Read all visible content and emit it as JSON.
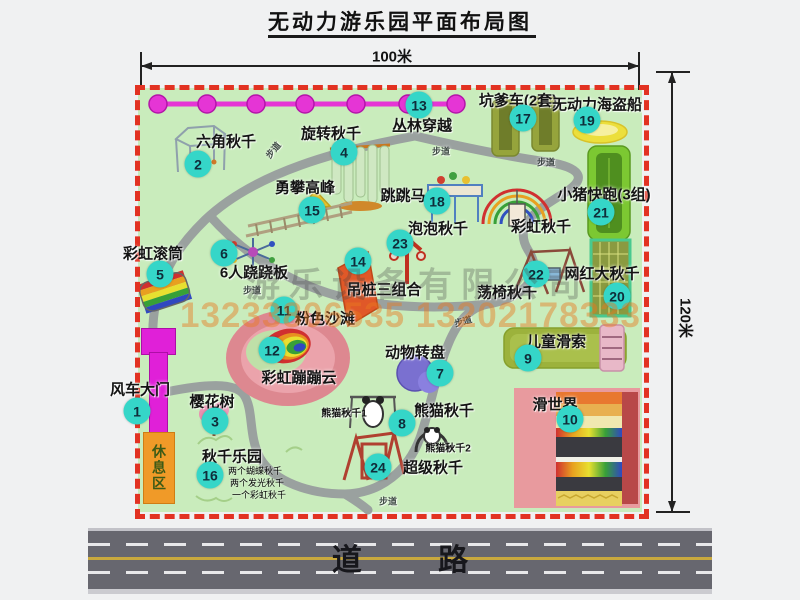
{
  "title": "无动力游乐园平面布局图",
  "dimensions": {
    "width_label": "100米",
    "height_label": "120米"
  },
  "road": {
    "label": "道 路"
  },
  "watermark": {
    "company": "游乐设备有限公司",
    "phone": "13233806535 13202178333"
  },
  "rest_area_label": "休息区",
  "walkway_label": "步道",
  "items": [
    {
      "num": "1",
      "label": "风车大门"
    },
    {
      "num": "2",
      "label": "六角秋千"
    },
    {
      "num": "3",
      "label": "樱花树"
    },
    {
      "num": "4",
      "label": "旋转秋千"
    },
    {
      "num": "5",
      "label": "彩虹滚筒"
    },
    {
      "num": "6",
      "label": "6人跷跷板"
    },
    {
      "num": "7",
      "label": "动物转盘"
    },
    {
      "num": "8",
      "label": "熊猫秋千"
    },
    {
      "num": "9",
      "label": "儿童滑索"
    },
    {
      "num": "10",
      "label": "滑世界"
    },
    {
      "num": "11",
      "label": "粉色沙滩"
    },
    {
      "num": "12",
      "label": "彩虹蹦蹦云"
    },
    {
      "num": "13",
      "label": "丛林穿越"
    },
    {
      "num": "14",
      "label": "吊桩三组合"
    },
    {
      "num": "15",
      "label": "勇攀高峰"
    },
    {
      "num": "16",
      "label": "秋千乐园",
      "notes": [
        "两个蝴蝶秋千",
        "两个发光秋千",
        "一个彩虹秋千"
      ]
    },
    {
      "num": "17",
      "label": "坑爹车(2套)"
    },
    {
      "num": "18",
      "label": "跳跳马"
    },
    {
      "num": "19",
      "label": "无动力海盗船"
    },
    {
      "num": "20",
      "label": "网红大秋千"
    },
    {
      "num": "21",
      "label": "小猪快跑(3组)"
    },
    {
      "num": "22",
      "label": "荡椅秋千"
    },
    {
      "num": "23",
      "label": "泡泡秋千"
    },
    {
      "num": "24",
      "label": "超级秋千"
    }
  ],
  "extra_labels": {
    "rainbow_swing": "彩虹秋千",
    "panda_swing_1": "熊猫秋千1",
    "panda_swing_2": "熊猫秋千2"
  },
  "colors": {
    "map_green": "#c9ecbc",
    "border_red": "#e23222",
    "badge_cyan": "#35d6c8",
    "gate_magenta": "#e020d8",
    "rest_orange": "#f09a28",
    "road_gray": "#67676f",
    "jungle_pink": "#e535d5"
  }
}
